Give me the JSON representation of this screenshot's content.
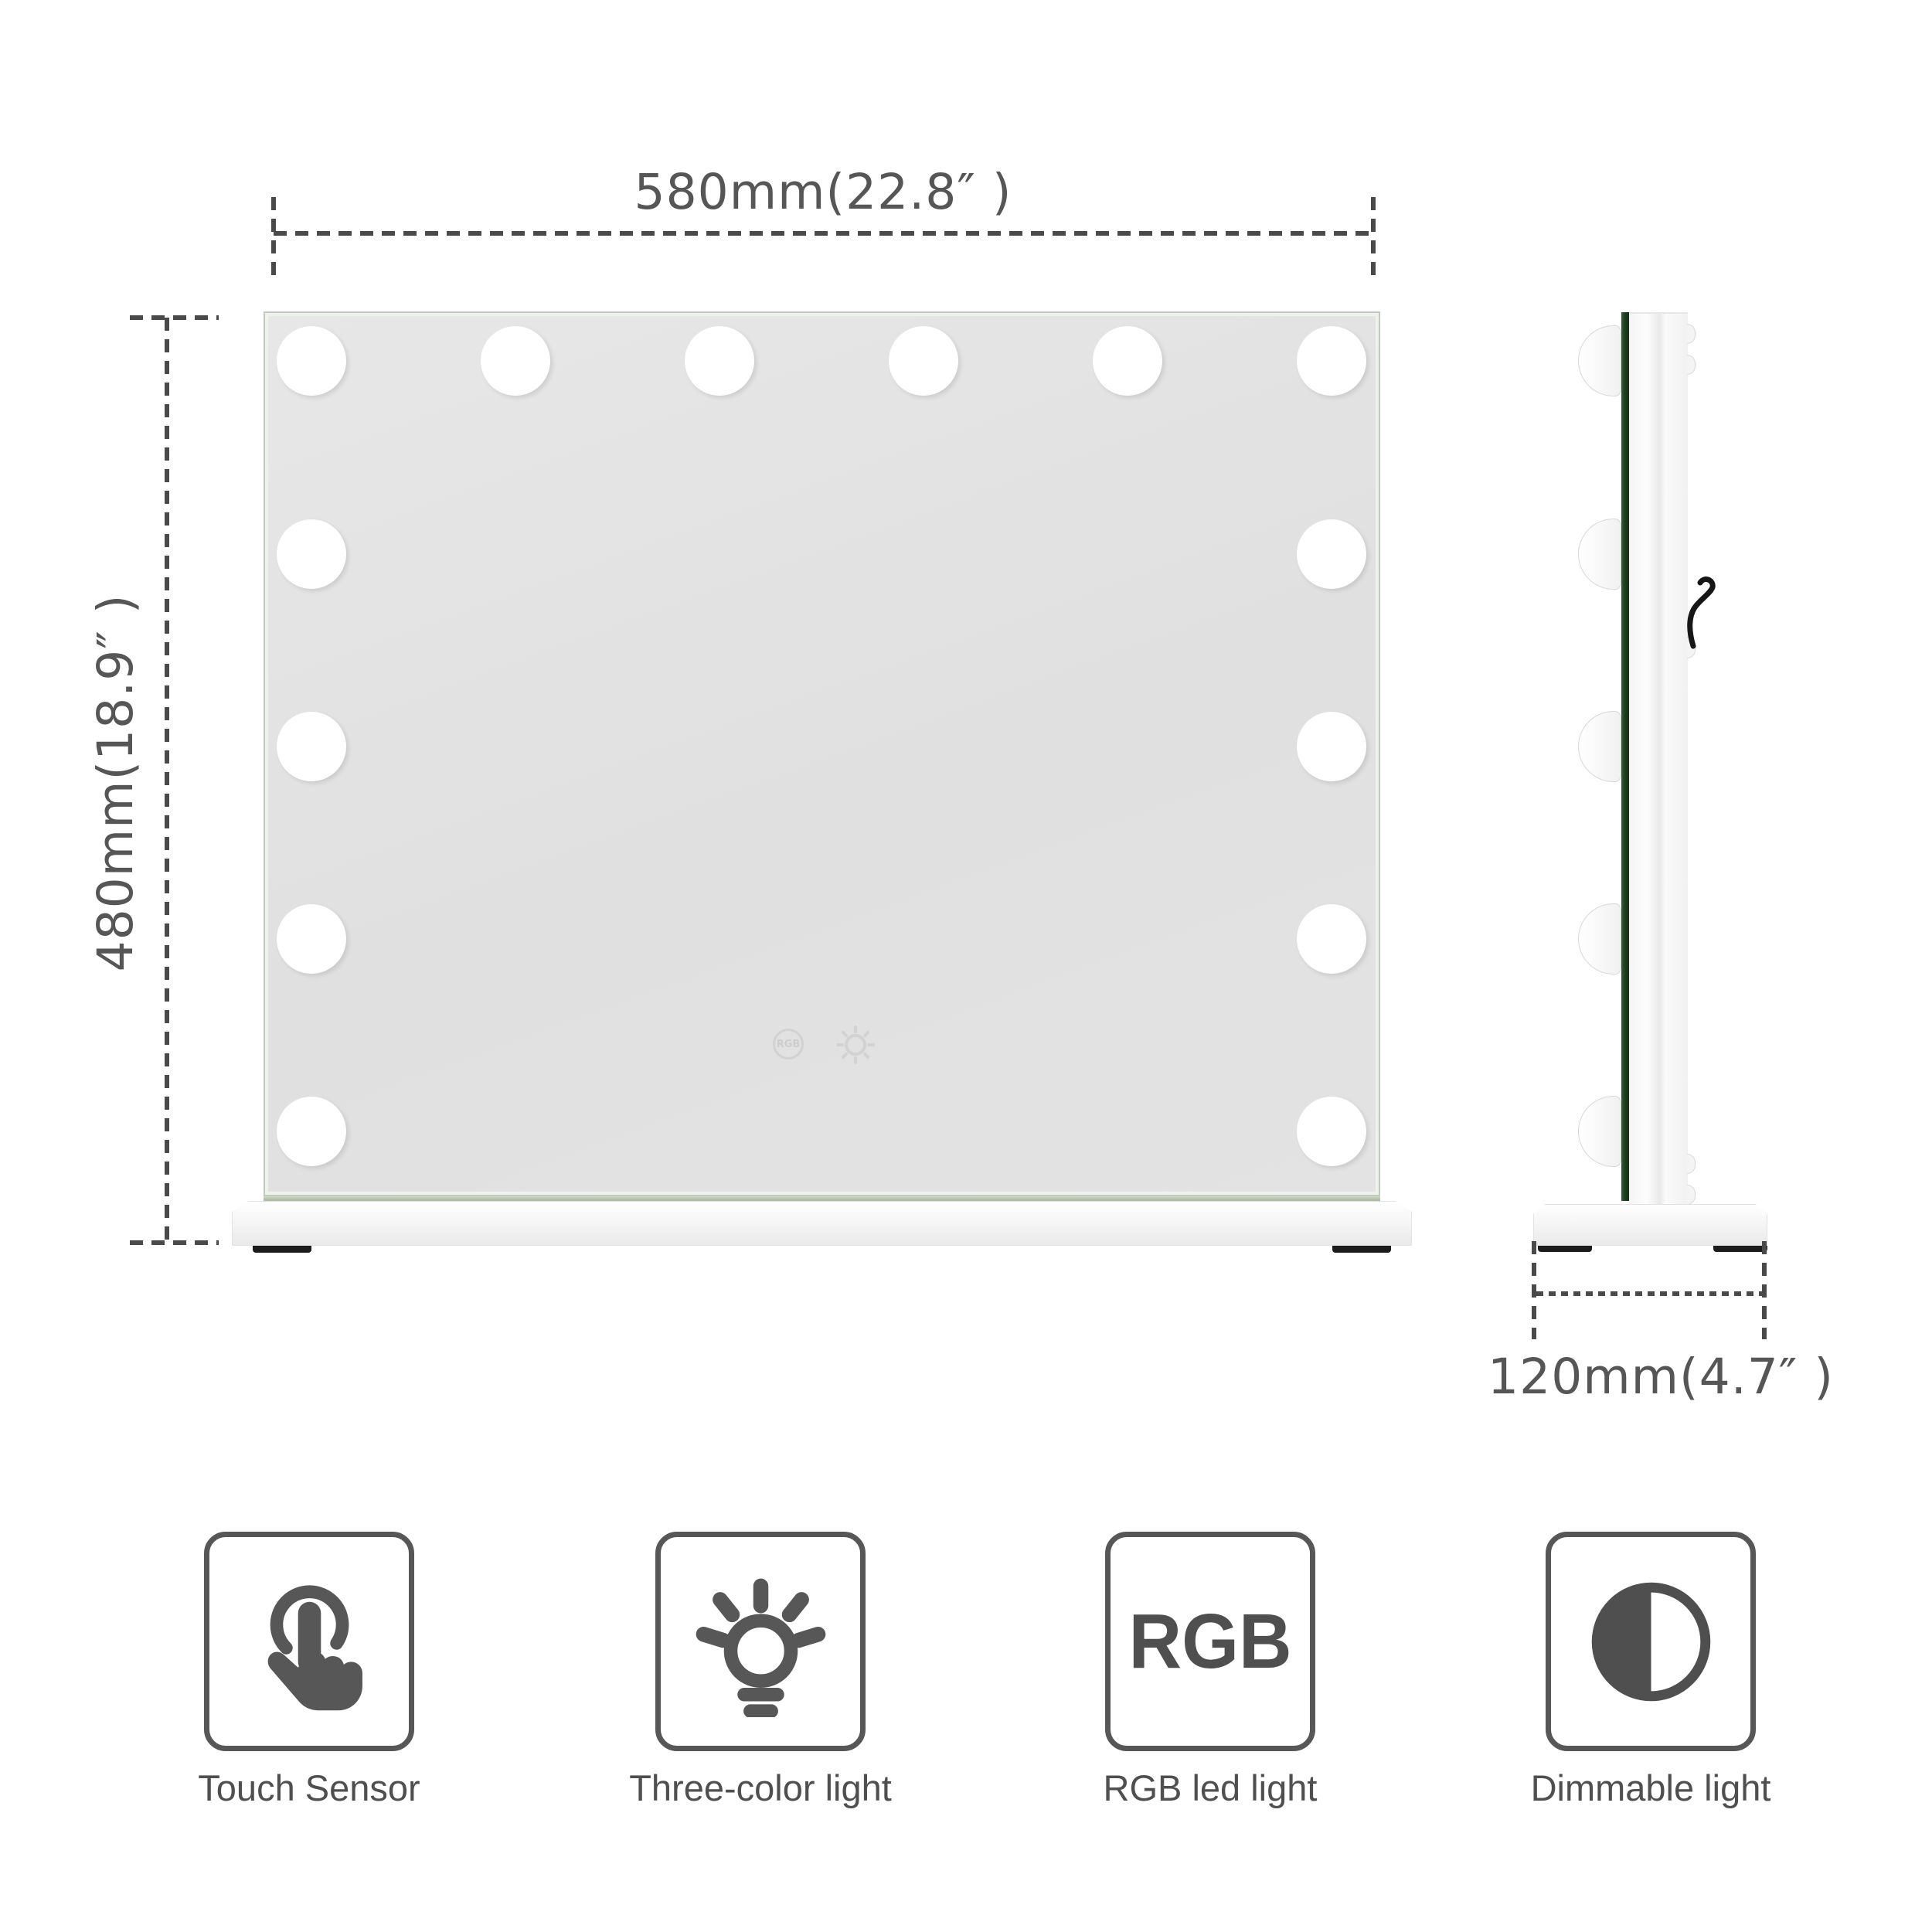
{
  "dimensions": {
    "front_width": "580mm(22.8″ )",
    "front_height": "480mm(18.9″ )",
    "side_depth": "120mm(4.7″ )"
  },
  "mirror": {
    "bulb_count_front": 14,
    "bulb_count_side": 5,
    "touch_controls": [
      {
        "icon": "rgb-mode-icon",
        "label": "RGB"
      },
      {
        "icon": "brightness-icon"
      }
    ]
  },
  "features": [
    {
      "icon": "touch-sensor-icon",
      "label": "Touch Sensor"
    },
    {
      "icon": "three-color-light-icon",
      "label": "Three-color light"
    },
    {
      "icon": "rgb-led-light-icon",
      "icon_text": "RGB",
      "label": "RGB led light"
    },
    {
      "icon": "dimmable-light-icon",
      "label": "Dimmable light"
    }
  ],
  "colors": {
    "dimension_line": "#4a4a4a",
    "dimension_text": "#565656",
    "mirror_glass": "#e2e2e2",
    "glass_edge_green": "#1d3f1e",
    "bulb": "#ffffff",
    "base_white": "#f6f6f6",
    "foot_black": "#1c1c1c",
    "feature_icon": "#575757"
  }
}
